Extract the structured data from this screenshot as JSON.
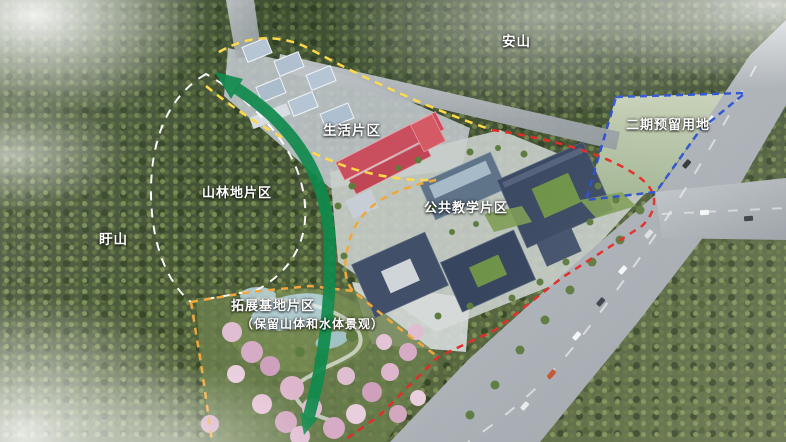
{
  "scene": {
    "type": "campus-masterplan-aerial-rendering",
    "labels": {
      "mountain_top": "安山",
      "mountain_left": "盱山",
      "living": "生活片区",
      "forest": "山林地片区",
      "teaching": "公共教学片区",
      "phase2": "二期预留用地",
      "expansion_line1": "拓展基地片区",
      "expansion_line2": "（保留山体和水体景观）"
    },
    "colors": {
      "living_boundary": "#ffd84a",
      "expansion_boundary": "#f0a83c",
      "campus_boundary": "#e12d28",
      "phase2_boundary": "#2b50cf",
      "forest_boundary": "#ffffff",
      "green_axis": "#0f8a4c"
    }
  }
}
